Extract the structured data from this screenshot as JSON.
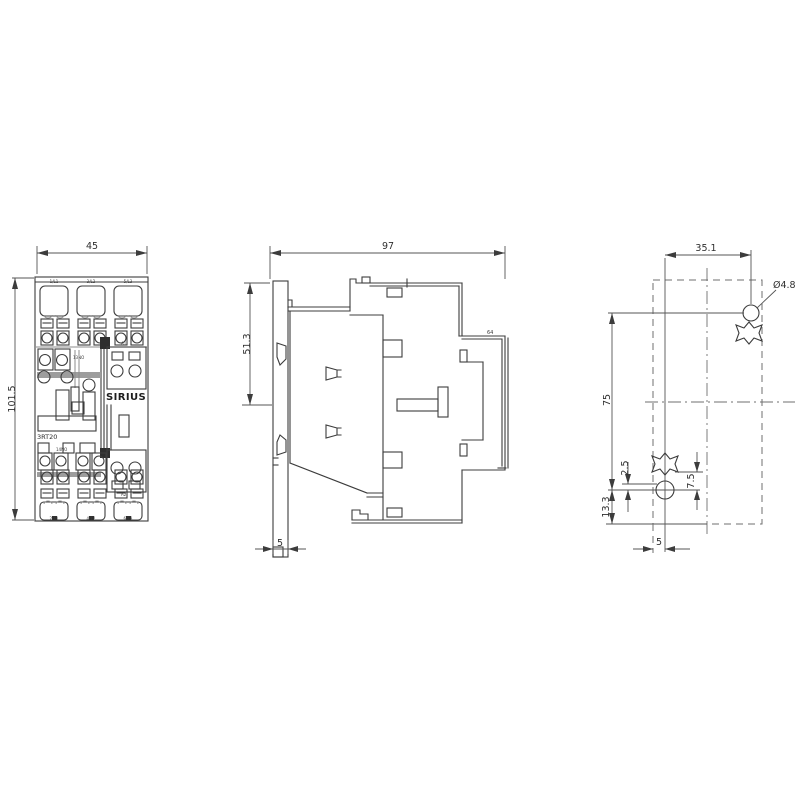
{
  "drawing_type": "technical dimensional drawing (contactor, 3 views)",
  "colors": {
    "background": "#ffffff",
    "object_line": "#3c3c3c",
    "dim_line": "#555555",
    "gray_line": "#8d8d8d"
  },
  "front": {
    "dim_width": "45",
    "dim_height": "101.5",
    "brand": "SIRIUS",
    "model": "3RT20",
    "terminals_top": [
      "1/L1",
      "3/L2",
      "5/L3"
    ],
    "terminals_bottom": [
      "2/T1",
      "4/T2",
      "6/T3"
    ],
    "aux_top": "13NO",
    "aux_bottom": "14NO",
    "coil_top": "A1",
    "coil_bottom": "A2"
  },
  "side": {
    "dim_depth": "97",
    "dim_front_height": "51.3",
    "dim_plate": "5",
    "dim_rear": "64"
  },
  "drill": {
    "dim_top": "35.1",
    "hole_dia": "Ø4.8",
    "dim_spacing": "75",
    "dim_bottom": "13.3",
    "dim_slot_a": "2.5",
    "dim_slot_b": "7.5",
    "dim_edge": "5"
  }
}
